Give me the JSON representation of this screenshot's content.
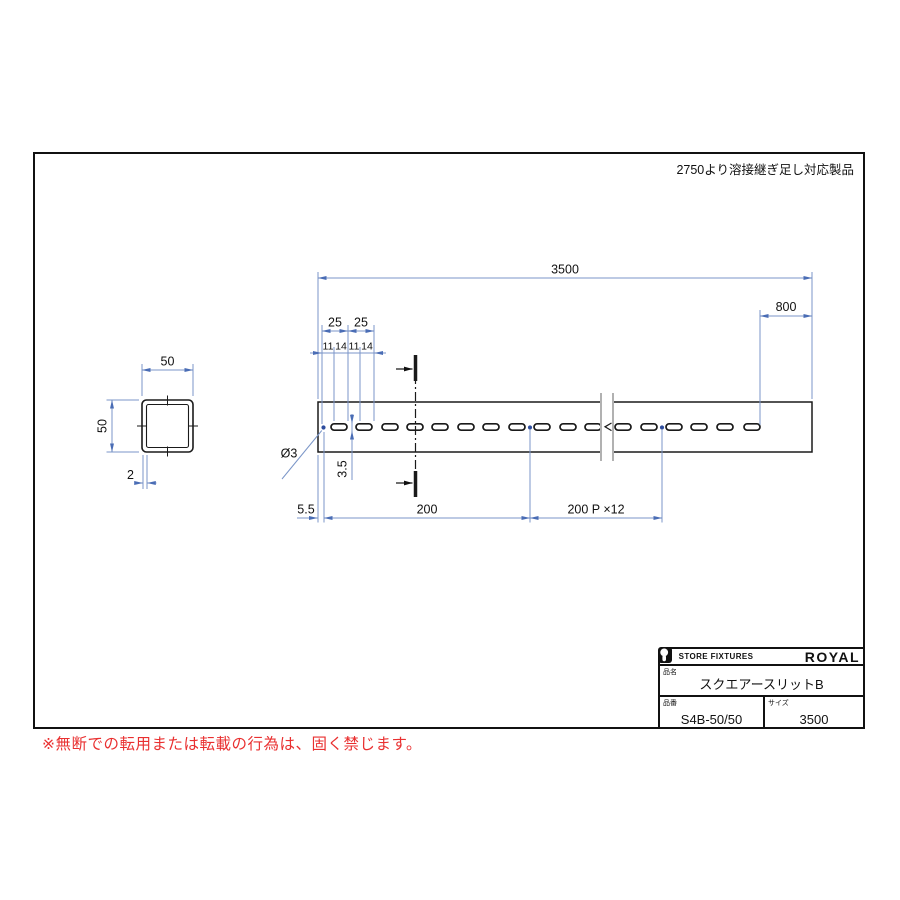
{
  "note": {
    "weld_extension": "2750より溶接継ぎ足し対応製品"
  },
  "footer": {
    "copyright": "※無断での転用または転載の行為は、固く禁じます。"
  },
  "title_block": {
    "store_label": "STORE FIXTURES",
    "brand": "ROYAL",
    "product_name_label": "品名",
    "product_name": "スクエアースリットB",
    "part_no_label": "品番",
    "part_no": "S4B-50/50",
    "size_label": "サイズ",
    "size": "3500"
  },
  "dimensions": {
    "overall_length": "3500",
    "right_end_length": "800",
    "slot_pitch_a": "25",
    "slot_pitch_b": "25",
    "seg_11_a": "11",
    "seg_14_a": "14",
    "seg_11_b": "11",
    "seg_14_b": "14",
    "hole_diameter": "Ø3",
    "slot_height": "3.5",
    "edge_offset": "5.5",
    "first_pitch": "200",
    "pitch_run": "200 P ×12"
  },
  "section": {
    "width": "50",
    "height": "50",
    "thickness": "2"
  },
  "colors": {
    "dimension_line": "#7b96c8",
    "dimension_arrow": "#4a6db5",
    "hole_dot": "#2e4d9e",
    "warning_red": "#e93030"
  }
}
